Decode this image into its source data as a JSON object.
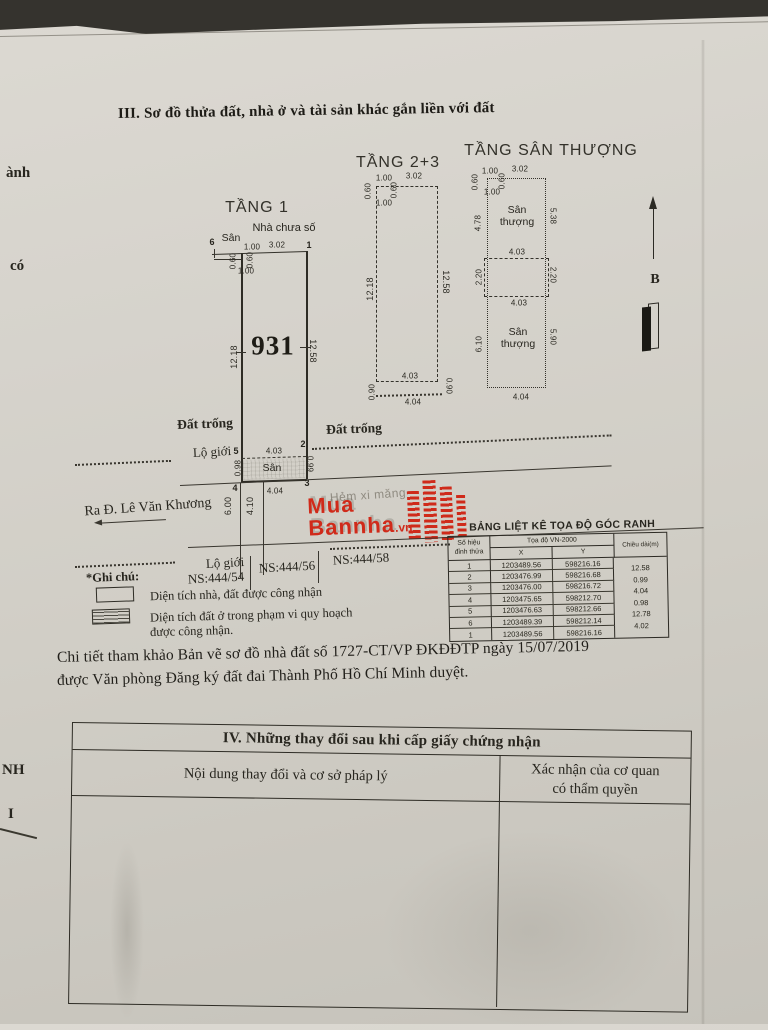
{
  "page": {
    "section3_title": "III. Sơ đồ thửa đất, nhà ở và tài sản khác gắn liền với đất"
  },
  "edge_fragments": {
    "f1": "ành",
    "f2": "có",
    "f3": "NH",
    "f4": "I"
  },
  "floor1": {
    "label": "TẦNG 1",
    "house_note": "Nhà chưa số",
    "yard_top": "Sân",
    "parcel_number": "931",
    "pt6": "6",
    "pt1": "1",
    "pt5": "5",
    "pt2": "2",
    "pt4": "4",
    "pt3": "3",
    "dim_top_left": "1.00",
    "dim_top": "3.02",
    "dim_setback_a": "0.60",
    "dim_setback_b": "0.60",
    "dim_setback_c": "1.00",
    "dim_left": "12.18",
    "dim_right": "12.58",
    "empty_left": "Đất trống",
    "empty_right": "Đất trống",
    "road_limit": "Lộ giới",
    "yard_bottom": "Sân",
    "dim_yard_top": "4.03",
    "dim_yard_left": "0.98",
    "dim_yard_right": "0.99",
    "dim_yard_bottom": "4.04"
  },
  "street": {
    "to_road": "Ra Đ. Lê Văn Khương",
    "alley": "Hẻm xi măng",
    "dim_road_width": "6.00",
    "dim_alley_width": "4.10",
    "road_limit": "Lộ giới",
    "house1": "NS:444/54",
    "house2": "NS:444/56",
    "house3": "NS:444/58"
  },
  "floor23": {
    "label": "TẦNG 2+3",
    "dim_top_left": "1.00",
    "dim_top": "3.02",
    "dim_setback_a": "0.60",
    "dim_setback_b": "0.60",
    "dim_setback_c": "1.00",
    "dim_left": "12.18",
    "dim_right": "12.58",
    "dim_bottom_in": "4.03",
    "dim_bottom_left": "0.90",
    "dim_bottom_right": "0.90",
    "dim_bottom": "4.04"
  },
  "roof": {
    "label": "TẦNG SÂN THƯỢNG",
    "terrace_top_1": "Sân",
    "terrace_top_2": "thượng",
    "terrace_bot_1": "Sân",
    "terrace_bot_2": "thượng",
    "dim_top_left": "1.00",
    "dim_top": "3.02",
    "dim_setback_a": "0.60",
    "dim_setback_b": "0.60",
    "dim_setback_c": "1.00",
    "dim_s1_left": "4.78",
    "dim_s1_right": "5.38",
    "dim_mid_top": "4.03",
    "dim_mid_left": "2.20",
    "dim_mid_right": "2.20",
    "dim_mid_bottom": "4.03",
    "dim_s2_left": "6.10",
    "dim_s2_right": "5.90",
    "dim_bottom": "4.04"
  },
  "compass": {
    "north": "B"
  },
  "watermark": {
    "line1": "Mua",
    "line2": "Bannha",
    "tld": ".vn"
  },
  "notes": {
    "marker": "*Ghi chú:",
    "legend1": "Diện tích nhà, đất được công nhận",
    "legend2a": "Diện tích đất ở trong phạm vi quy hoạch",
    "legend2b": "được công nhận.",
    "ref1": "Chi tiết tham khảo Bản vẽ sơ đồ nhà đất số 1727-CT/VP ĐKĐĐTP ngày 15/07/2019",
    "ref2": "được Văn phòng Đăng ký đất đai Thành Phố Hồ Chí Minh duyệt."
  },
  "coord_table": {
    "title": "BẢNG LIỆT KÊ TỌA ĐỘ GÓC RANH",
    "col_point_1": "Số hiệu",
    "col_point_2": "đỉnh thửa",
    "col_coords": "Tọa độ VN-2000",
    "col_x": "X",
    "col_y": "Y",
    "col_len": "Chiều dài(m)",
    "rows": [
      {
        "p": "1",
        "x": "1203489.56",
        "y": "598216.16"
      },
      {
        "p": "2",
        "x": "1203476.99",
        "y": "598216.68"
      },
      {
        "p": "3",
        "x": "1203476.00",
        "y": "598216.72"
      },
      {
        "p": "4",
        "x": "1203475.65",
        "y": "598212.70"
      },
      {
        "p": "5",
        "x": "1203476.63",
        "y": "598212.66"
      },
      {
        "p": "6",
        "x": "1203489.39",
        "y": "598212.14"
      },
      {
        "p": "1",
        "x": "1203489.56",
        "y": "598216.16"
      }
    ],
    "lengths": [
      "12.58",
      "0.99",
      "4.04",
      "0.98",
      "12.78",
      "4.02"
    ]
  },
  "section4": {
    "title": "IV. Những thay đổi sau khi cấp giấy chứng nhận",
    "col1": "Nội dung thay đổi và cơ sở pháp lý",
    "col2a": "Xác nhận của cơ quan",
    "col2b": "có thẩm quyền"
  },
  "colors": {
    "accent_red": "#d02a1a",
    "ink": "#26241d",
    "paper": "#d3d0c8"
  }
}
